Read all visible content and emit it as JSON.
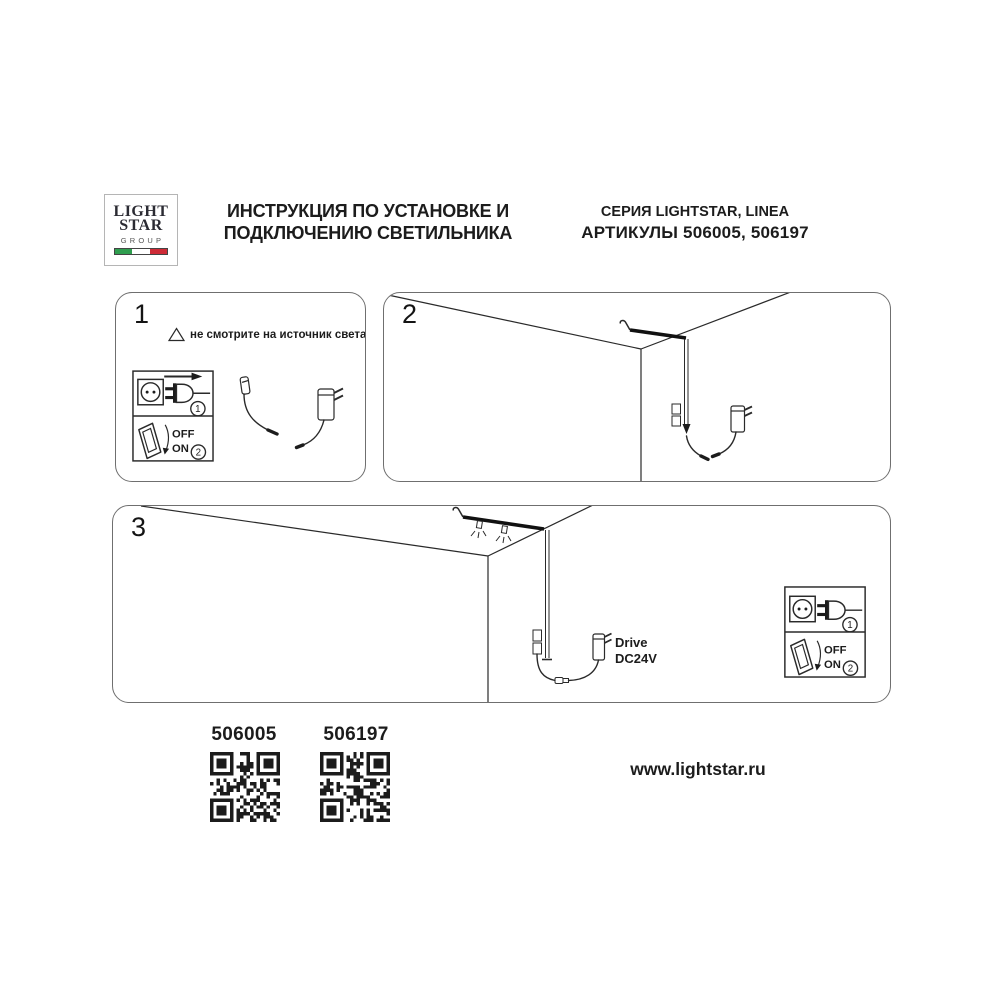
{
  "header": {
    "logo": {
      "word1": "LIGHT",
      "word2": "STAR",
      "word3": "GROUP"
    },
    "title": {
      "line1": "ИНСТРУКЦИЯ ПО УСТАНОВКЕ И",
      "line2": "ПОДКЛЮЧЕНИЮ СВЕТИЛЬНИКА"
    },
    "series": {
      "line1": "СЕРИЯ LIGHTSTAR, LINEA",
      "line2": "АРТИКУЛЫ 506005, 506197"
    }
  },
  "steps": {
    "one": {
      "number": "1",
      "warning_text": "не смотрите на источник света"
    },
    "two": {
      "number": "2"
    },
    "three": {
      "number": "3",
      "drive_line1": "Drive",
      "drive_line2": "DC24V"
    }
  },
  "power_icons": {
    "off_label": "OFF",
    "on_label": "ON",
    "plug_step": "1",
    "switch_step": "2"
  },
  "footer": {
    "article1": "506005",
    "article2": "506197",
    "website": "www.lightstar.ru"
  },
  "colors": {
    "ink": "#1c1c1c",
    "panel_border": "#6f6f6f",
    "flag_green": "#2f9e4f",
    "flag_red": "#ce2b37"
  }
}
